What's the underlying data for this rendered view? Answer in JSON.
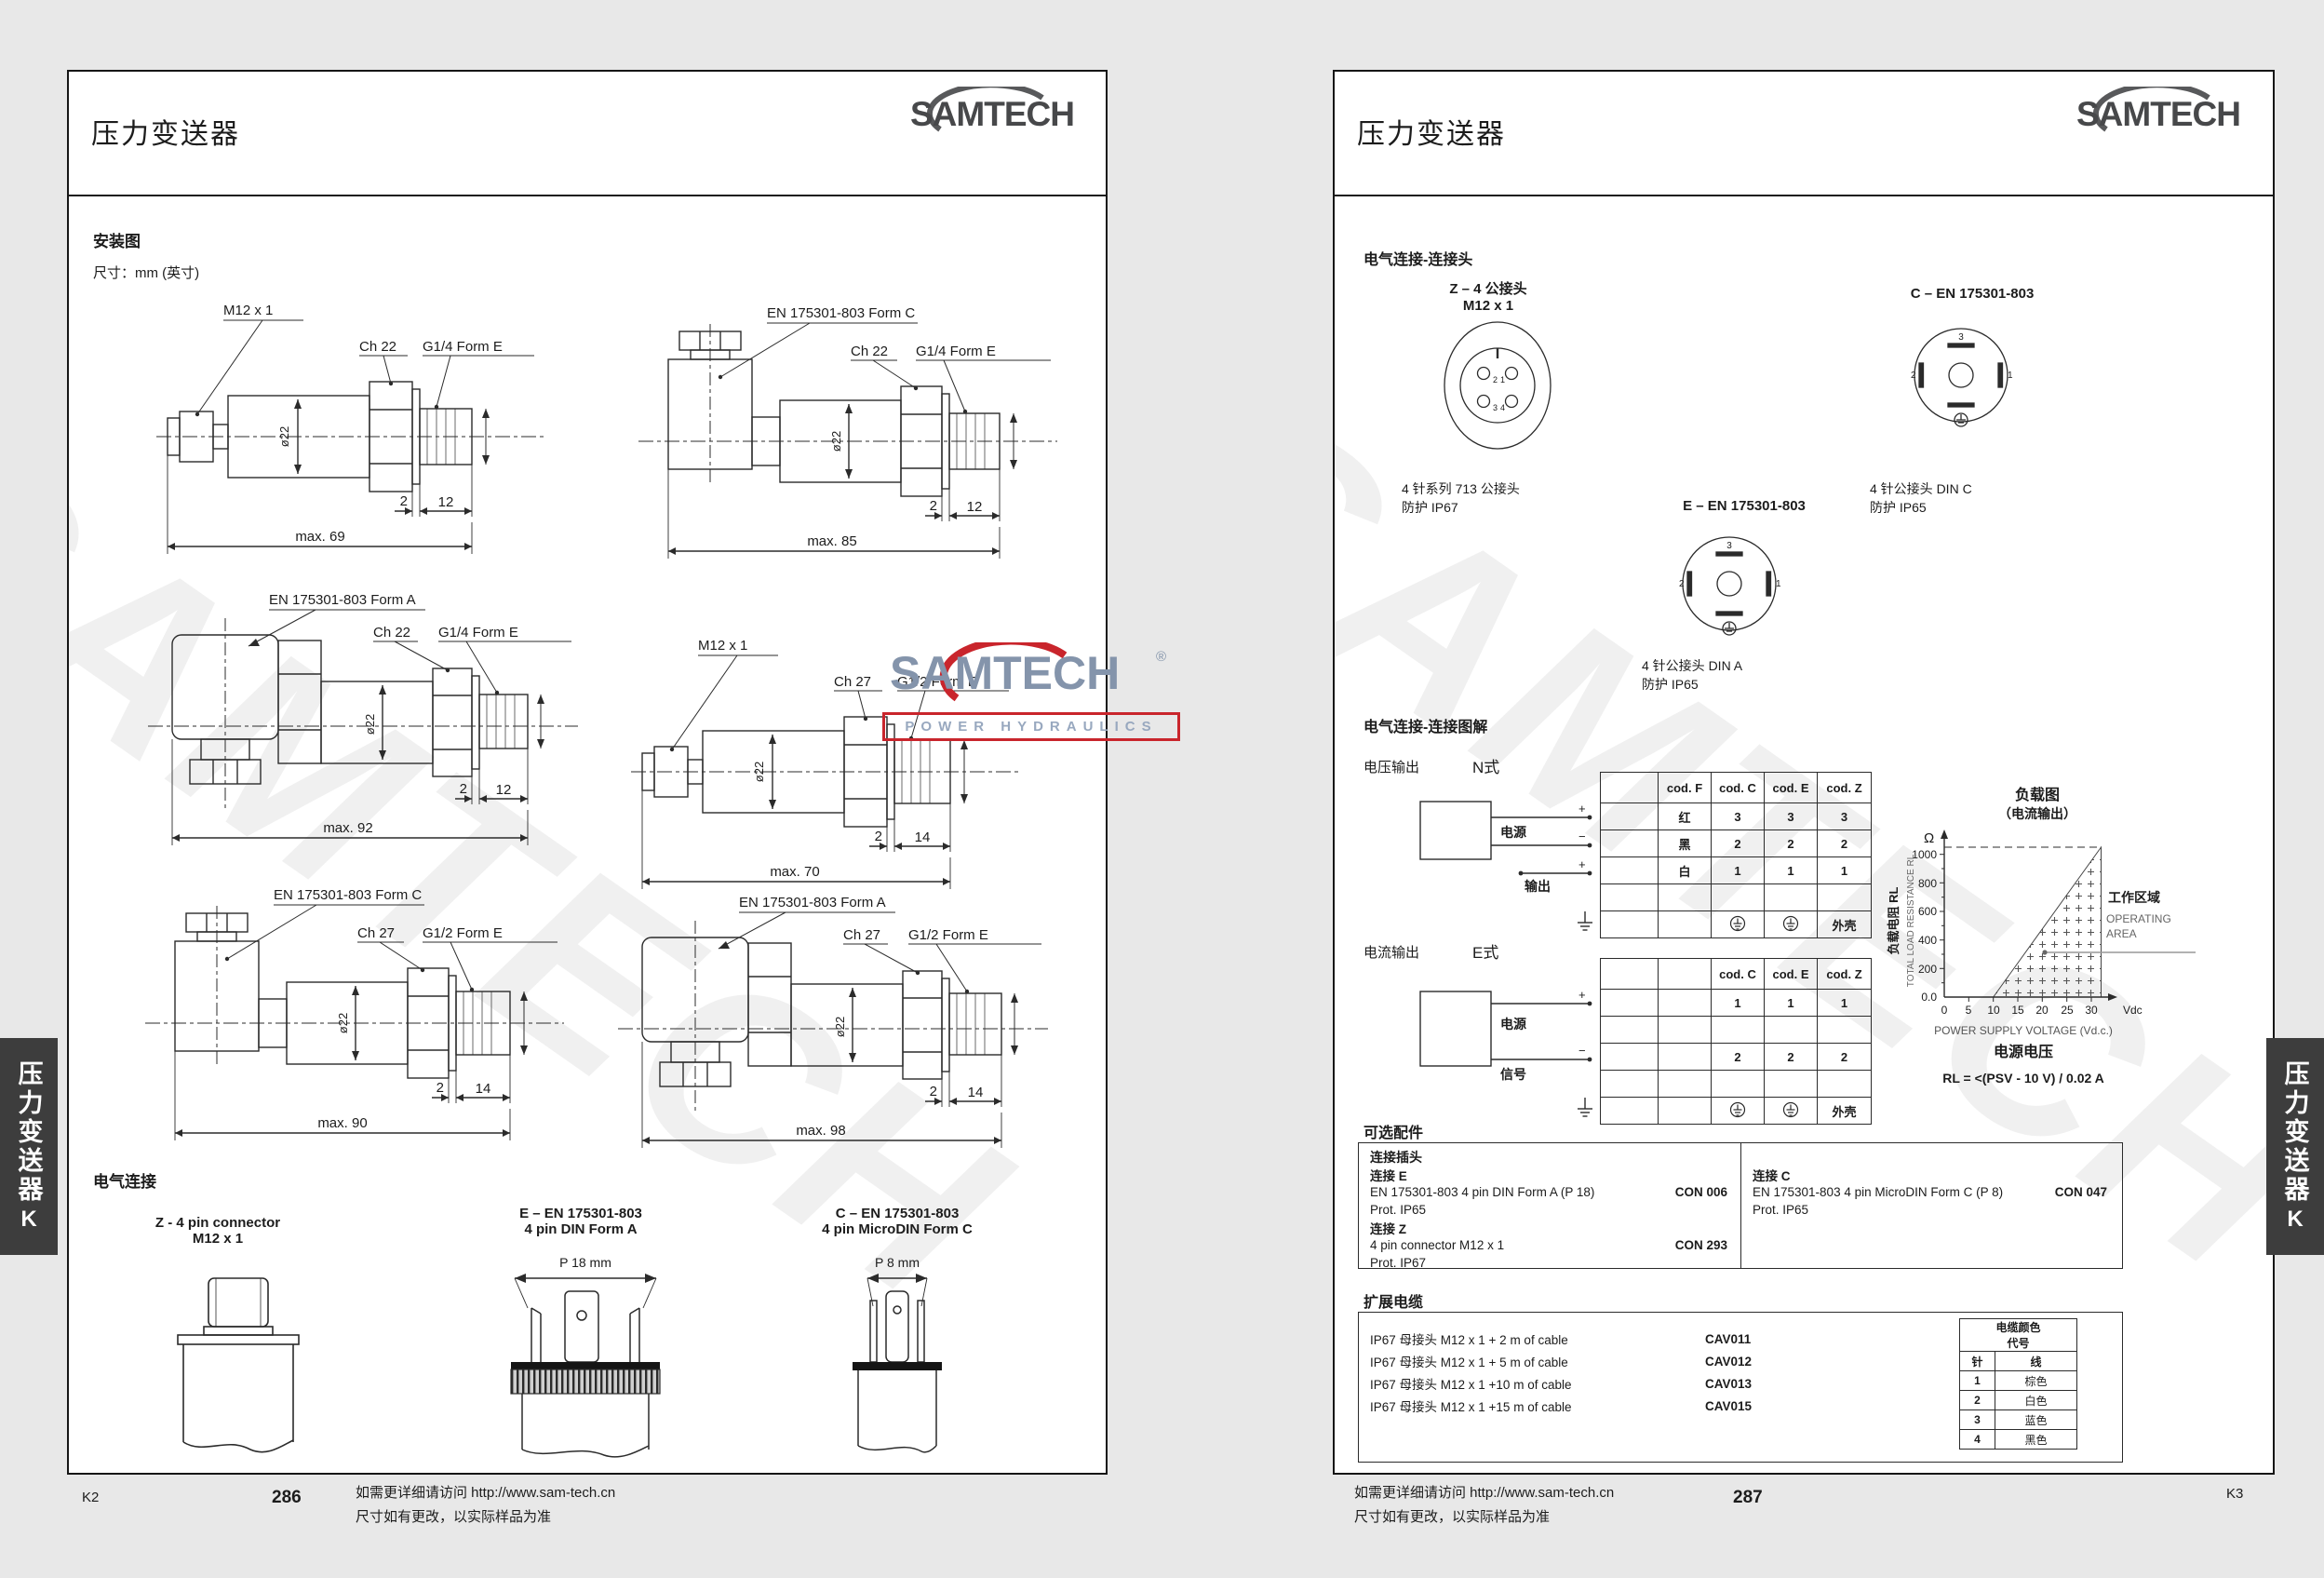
{
  "brand": {
    "name": "SAMTECH",
    "reg": "®",
    "tagline": "POWER HYDRAULICS"
  },
  "tab": {
    "label": "压力变送器",
    "letter": "K"
  },
  "footer": {
    "note1": "如需更详细请访问 http://www.sam-tech.cn",
    "note2": "尺寸如有更改，以实际样品为准"
  },
  "left": {
    "title": "压力变送器",
    "sec_mount": "安装图",
    "dims_note": "尺寸：mm (英寸)",
    "d1": {
      "conn": "M12 x 1",
      "hex": "Ch 22",
      "port": "G1/4 Form E",
      "dia": "ø22",
      "a": "2",
      "b": "12",
      "max": "max. 69"
    },
    "d2": {
      "conn": "EN 175301-803 Form C",
      "hex": "Ch 22",
      "port": "G1/4 Form E",
      "dia": "ø22",
      "a": "2",
      "b": "12",
      "max": "max. 85"
    },
    "d3": {
      "conn": "EN 175301-803 Form A",
      "hex": "Ch 22",
      "port": "G1/4 Form E",
      "dia": "ø22",
      "a": "2",
      "b": "12",
      "max": "max. 92"
    },
    "d4": {
      "conn": "M12 x 1",
      "hex": "Ch 27",
      "port": "G1/2 Form E",
      "dia": "ø22",
      "a": "2",
      "b": "14",
      "max": "max. 70"
    },
    "d5": {
      "conn": "EN 175301-803 Form C",
      "hex": "Ch 27",
      "port": "G1/2 Form E",
      "dia": "ø22",
      "a": "2",
      "b": "14",
      "max": "max. 90"
    },
    "d6": {
      "conn": "EN 175301-803 Form A",
      "hex": "Ch 27",
      "port": "G1/2 Form E",
      "dia": "ø22",
      "a": "2",
      "b": "14",
      "max": "max. 98"
    },
    "sec_elec": "电气连接",
    "cz": {
      "l1": "Z - 4 pin connector",
      "l2": "M12 x 1"
    },
    "ce": {
      "l1": "E – EN 175301-803",
      "l2": "4 pin DIN Form A",
      "dim": "P 18 mm"
    },
    "cc": {
      "l1": "C – EN 175301-803",
      "l2": "4 pin MicroDIN Form C",
      "dim": "P 8 mm"
    },
    "page_no": "286",
    "corner": "K2"
  },
  "right": {
    "title": "压力变送器",
    "sec_conn": "电气连接-连接头",
    "z": {
      "t1": "Z – 4 公接头",
      "t2": "M12 x 1",
      "c1": "4 针系列 713 公接头",
      "c2": "防护 IP67",
      "p1": "1",
      "p2": "2",
      "p3": "3",
      "p4": "4"
    },
    "c": {
      "t": "C – EN 175301-803",
      "c1": "4 针公接头 DIN C",
      "c2": "防护 IP65",
      "p1": "1",
      "p2": "2",
      "p3": "3"
    },
    "e": {
      "t": "E – EN 175301-803",
      "c1": "4 针公接头 DIN A",
      "c2": "防护 IP65",
      "p1": "1",
      "p2": "2",
      "p3": "3"
    },
    "sec_wire": "电气连接-连接图解",
    "v": {
      "label": "电压输出",
      "type": "N式",
      "power": "电源",
      "out": "输出",
      "plus": "+",
      "minus": "−",
      "h": [
        "cod. F",
        "cod. C",
        "cod. E",
        "cod. Z"
      ],
      "r1": [
        "红",
        "3",
        "3",
        "3"
      ],
      "r2": [
        "黑",
        "2",
        "2",
        "2"
      ],
      "r3": [
        "白",
        "1",
        "1",
        "1"
      ],
      "shell": "外壳"
    },
    "i": {
      "label": "电流输出",
      "type": "E式",
      "power": "电源",
      "sig": "信号",
      "plus": "+",
      "minus": "−",
      "h": [
        "cod. C",
        "cod. E",
        "cod. Z"
      ],
      "r1": [
        "1",
        "1",
        "1"
      ],
      "r2": [
        "2",
        "2",
        "2"
      ],
      "shell": "外壳"
    },
    "chart": {
      "t1": "负载图",
      "t2": "（电流输出）",
      "unit": "Ω",
      "y": [
        "1000",
        "800",
        "600",
        "400",
        "200",
        "0.0"
      ],
      "x": [
        "0",
        "5",
        "10",
        "15",
        "20",
        "25",
        "30"
      ],
      "xu": "Vdc",
      "ylzh": "负载电阻 RL",
      "ylen": "TOTAL LOAD RESISTANCE RL",
      "xlen": "POWER SUPPLY VOLTAGE (Vd.c.)",
      "xlzh": "电源电压",
      "azh": "工作区域",
      "aen1": "OPERATING",
      "aen2": "AREA",
      "formula": "RL = <(PSV - 10 V) / 0.02 A"
    },
    "sec_acc": "可选配件",
    "acc": {
      "head": "连接插头",
      "e_n": "连接 E",
      "e_d": "EN 175301-803 4 pin DIN Form A (P 18)",
      "e_c": "CON 006",
      "e_p": "Prot. IP65",
      "z_n": "连接 Z",
      "z_d": "4 pin connector  M12 x 1",
      "z_c": "CON 293",
      "z_p": "Prot. IP67",
      "c_n": "连接 C",
      "c_d": "EN 175301-803 4 pin MicroDIN Form C (P 8)",
      "c_c": "CON 047",
      "c_p": "Prot. IP65"
    },
    "sec_cab": "扩展电缆",
    "cab": {
      "r1d": "IP67 母接头  M12 x 1 + 2 m of cable",
      "r1c": "CAV011",
      "r2d": "IP67 母接头  M12 x 1 + 5 m of cable",
      "r2c": "CAV012",
      "r3d": "IP67 母接头  M12 x 1 +10 m of cable",
      "r3c": "CAV013",
      "r4d": "IP67 母接头  M12 x 1 +15 m of cable",
      "r4c": "CAV015"
    },
    "cc_tbl": {
      "t1": "电缆颜色",
      "t2": "代号",
      "pin": "针",
      "wire": "线",
      "rows": [
        [
          "1",
          "棕色"
        ],
        [
          "2",
          "白色"
        ],
        [
          "3",
          "蓝色"
        ],
        [
          "4",
          "黑色"
        ]
      ]
    },
    "page_no": "287",
    "corner": "K3"
  },
  "chart_data": {
    "type": "area",
    "title": "负载图（电流输出） Load diagram (current output)",
    "xlabel": "POWER SUPPLY VOLTAGE (Vd.c.) 电源电压",
    "ylabel": "负载电阻 RL TOTAL LOAD RESISTANCE RL (Ω)",
    "xlim": [
      0,
      32
    ],
    "ylim": [
      0,
      1050
    ],
    "x_ticks": [
      0,
      5,
      10,
      15,
      20,
      25,
      30
    ],
    "y_ticks": [
      0,
      200,
      400,
      600,
      800,
      1000
    ],
    "operating_area_polygon_v_ohm": [
      [
        10,
        0
      ],
      [
        32,
        1050
      ],
      [
        32,
        0
      ]
    ],
    "boundary_rule": "RL = <(PSV - 10 V) / 0.02 A"
  }
}
